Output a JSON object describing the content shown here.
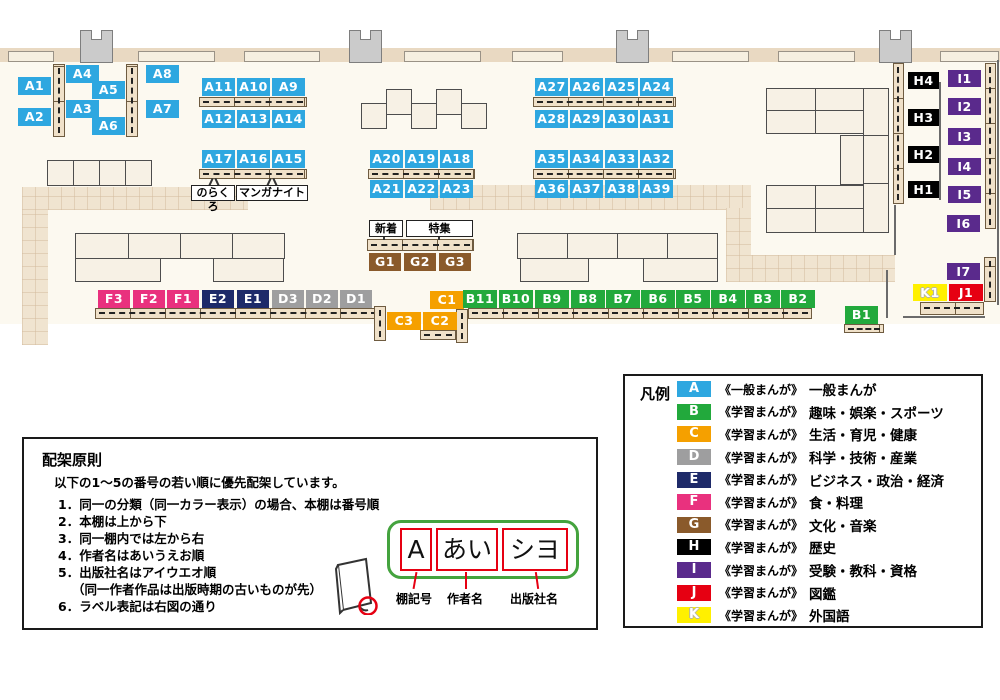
{
  "map": {
    "labels": {
      "a1": "A1",
      "a2": "A2",
      "a3": "A3",
      "a4": "A4",
      "a5": "A5",
      "a6": "A6",
      "a7": "A7",
      "a8": "A8",
      "a9": "A9",
      "a10": "A10",
      "a11": "A11",
      "a12": "A12",
      "a13": "A13",
      "a14": "A14",
      "a15": "A15",
      "a16": "A16",
      "a17": "A17",
      "a18": "A18",
      "a19": "A19",
      "a20": "A20",
      "a21": "A21",
      "a22": "A22",
      "a23": "A23",
      "a24": "A24",
      "a25": "A25",
      "a26": "A26",
      "a27": "A27",
      "a28": "A28",
      "a29": "A29",
      "a30": "A30",
      "a31": "A31",
      "a32": "A32",
      "a33": "A33",
      "a34": "A34",
      "a35": "A35",
      "a36": "A36",
      "a37": "A37",
      "a38": "A38",
      "a39": "A39",
      "b1": "B1",
      "b2": "B2",
      "b3": "B3",
      "b4": "B4",
      "b5": "B5",
      "b6": "B6",
      "b7": "B7",
      "b8": "B8",
      "b9": "B9",
      "b10": "B10",
      "b11": "B11",
      "c1": "C1",
      "c2": "C2",
      "c3": "C3",
      "d1": "D1",
      "d2": "D2",
      "d3": "D3",
      "e1": "E1",
      "e2": "E2",
      "f1": "F1",
      "f2": "F2",
      "f3": "F3",
      "g1": "G1",
      "g2": "G2",
      "g3": "G3",
      "h1": "H1",
      "h2": "H2",
      "h3": "H3",
      "h4": "H4",
      "i1": "I1",
      "i2": "I2",
      "i3": "I3",
      "i4": "I4",
      "i5": "I5",
      "i6": "I6",
      "i7": "I7",
      "j1": "J1",
      "k1": "K1"
    },
    "callouts": {
      "norakuro": "のらくろ",
      "manga_night": "マンガナイト",
      "new_arrivals": "新着",
      "feature": "特集"
    }
  },
  "legend": {
    "title": "凡例",
    "rows": [
      {
        "key": "A",
        "type": "《一般まんが》",
        "category": "一般まんが",
        "color": "#2EA7E0"
      },
      {
        "key": "B",
        "type": "《学習まんが》",
        "category": "趣味・娯楽・スポーツ",
        "color": "#22A93C"
      },
      {
        "key": "C",
        "type": "《学習まんが》",
        "category": "生活・育児・健康",
        "color": "#F5A000"
      },
      {
        "key": "D",
        "type": "《学習まんが》",
        "category": "科学・技術・産業",
        "color": "#9E9E9F"
      },
      {
        "key": "E",
        "type": "《学習まんが》",
        "category": "ビジネス・政治・経済",
        "color": "#1E2A69"
      },
      {
        "key": "F",
        "type": "《学習まんが》",
        "category": "食・料理",
        "color": "#E9317E"
      },
      {
        "key": "G",
        "type": "《学習まんが》",
        "category": "文化・音楽",
        "color": "#8A5A2B"
      },
      {
        "key": "H",
        "type": "《学習まんが》",
        "category": "歴史",
        "color": "#000000"
      },
      {
        "key": "I",
        "type": "《学習まんが》",
        "category": "受験・教科・資格",
        "color": "#5A2A8C"
      },
      {
        "key": "J",
        "type": "《学習まんが》",
        "category": "図鑑",
        "color": "#E60012"
      },
      {
        "key": "K",
        "type": "《学習まんが》",
        "category": "外国語",
        "color": "#FFF000"
      }
    ]
  },
  "principles": {
    "title": "配架原則",
    "intro": "以下の1～5の番号の若い順に優先配架しています。",
    "items": [
      "1．同一の分類（同一カラー表示）の場合、本棚は番号順",
      "2．本棚は上から下",
      "3．同一棚内では左から右",
      "4．作者名はあいうえお順",
      "5．出版社名はアイウエオ順",
      "（同一作者作品は出版時期の古いものが先）",
      "6．ラベル表記は右図の通り"
    ],
    "label_diagram": {
      "segments": [
        "A",
        "あい",
        "シヨ"
      ],
      "captions": [
        "棚記号",
        "作者名",
        "出版社名"
      ]
    }
  }
}
